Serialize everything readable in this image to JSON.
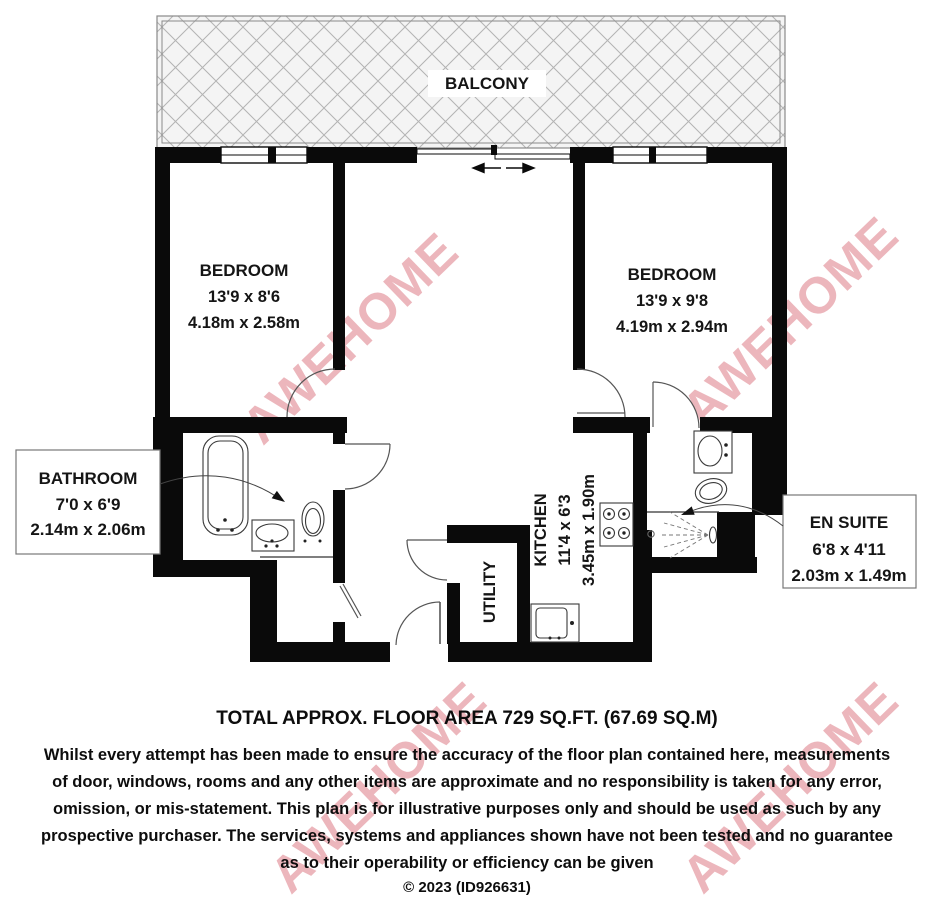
{
  "floorplan": {
    "balcony": {
      "label": "BALCONY"
    },
    "bedroom_left": {
      "name": "BEDROOM",
      "size_imperial": "13'9 x 8'6",
      "size_metric": "4.18m x 2.58m"
    },
    "bedroom_right": {
      "name": "BEDROOM",
      "size_imperial": "13'9 x 9'8",
      "size_metric": "4.19m x 2.94m"
    },
    "bathroom": {
      "name": "BATHROOM",
      "size_imperial": "7'0 x 6'9",
      "size_metric": "2.14m x 2.06m"
    },
    "en_suite": {
      "name": "EN SUITE",
      "size_imperial": "6'8 x 4'11",
      "size_metric": "2.03m x 1.49m"
    },
    "kitchen": {
      "name": "KITCHEN",
      "size_imperial": "11'4 x 6'3",
      "size_metric": "3.45m x 1.90m"
    },
    "utility": {
      "name": "UTILITY"
    },
    "watermark": {
      "text": "AWEHOME",
      "color": "#d6606c"
    },
    "wall_color": "#0a0a0a"
  },
  "footer": {
    "total_area": "TOTAL APPROX. FLOOR AREA 729 SQ.FT. (67.69 SQ.M)",
    "disclaimer_lines": [
      "Whilst every attempt has been made to ensure the accuracy of the floor plan contained here, measurements",
      "of door, windows, rooms and any other items are approximate and no responsibility is taken for any error,",
      "omission, or mis-statement. This plan is for illustrative purposes only and should be used as such by any",
      "prospective purchaser. The services, systems and appliances shown have not been tested and no guarantee",
      "as to their operability or efficiency can be given"
    ],
    "copyright": "© 2023 (ID926631)"
  }
}
